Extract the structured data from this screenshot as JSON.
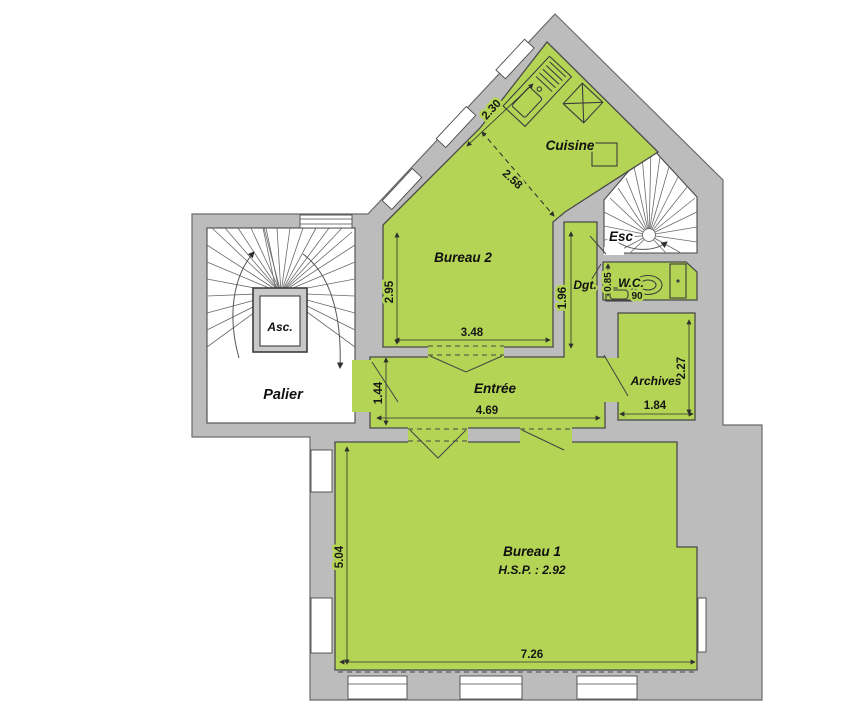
{
  "plan": {
    "rooms": {
      "cuisine": "Cuisine",
      "bureau2": "Bureau 2",
      "esc": "Esc",
      "dgt": "Dgt.",
      "wc": "W.C.",
      "archives": "Archives",
      "entree": "Entrée",
      "palier": "Palier",
      "asc": "Asc.",
      "bureau1": "Bureau 1",
      "bureau1_hsp": "H.S.P. : 2.92"
    },
    "dimensions": {
      "cuisine_counter": "2.30",
      "cuisine_width": "2.58",
      "bureau2_depth": "2.95",
      "bureau2_width": "3.48",
      "dgt_length": "1.96",
      "wc_depth": "0.85",
      "wc_width": "90",
      "archives_depth": "2.27",
      "archives_width": "1.84",
      "entree_width": "4.69",
      "entree_depth": "1.44",
      "bureau1_depth": "5.04",
      "bureau1_width": "7.26"
    },
    "colors": {
      "room_fill": "#b3d455",
      "wall_fill": "#bcbcbc"
    }
  }
}
